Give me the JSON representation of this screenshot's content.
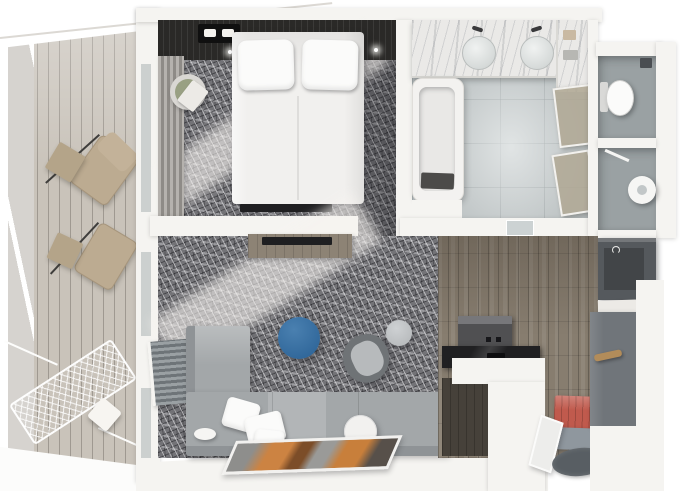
{
  "scene": {
    "kind": "3d-floor-plan-render",
    "view": "top-down cutaway (dollhouse)",
    "unit": "one-bedroom suite with balcony",
    "size": "680x491"
  },
  "palette": {
    "wall": "#f5f4f1",
    "wall-shade": "#e2e0db",
    "deck": "#c9c3ba",
    "railing-glass": "#d6d3cf",
    "carpet": "#737377",
    "bed": "#f1f0ee",
    "pillow": "#fbfbfa",
    "headboard": "#2a2927",
    "wood": "#877d6f",
    "tile": "#b9bfc0",
    "marble": "#eae9e7",
    "wc-floor": "#9aa1a3",
    "sofa": "#a3a7a9",
    "sofa-shade": "#8f9396",
    "ottoman-blue": "#31689b",
    "armchair": "#6f7376",
    "pouf": "#b9bcbe",
    "bench-coral": "#c05a4d",
    "rug-dark": "#585e63",
    "closet": "#55595d",
    "wardrobe": "#70757a",
    "rod-wood": "#b28c5a",
    "curtain-a": "#b5b2ae",
    "curtain-b": "#8e8b87",
    "cushion-beige": "#bcab91",
    "table-beige": "#b4a489",
    "tv-dark": "#1f1f21",
    "counter-dark": "#202022",
    "cabinet-dark": "#46413a",
    "appliance": "#505052",
    "art-orange": "#cc8342",
    "console-wood": "#8d8375"
  },
  "rooms": [
    {
      "id": "balcony",
      "name": "Balcony",
      "floor": "wood slat decking",
      "items": [
        "lounge chair",
        "lounge chair",
        "beige side table",
        "beige side table",
        "rope hammock",
        "white throw pillow",
        "glass railing"
      ]
    },
    {
      "id": "bedroom",
      "name": "Bedroom",
      "floor": "grey patterned carpet",
      "items": [
        "double bed",
        "two pillows",
        "dark headboard wall",
        "ceiling light fixture",
        "round lounge chair",
        "pleated curtains",
        "wall tv"
      ]
    },
    {
      "id": "bathroom",
      "name": "Bathroom",
      "floor": "grey tile",
      "items": [
        "marble double vanity",
        "vessel sink",
        "vessel sink",
        "faucet",
        "faucet",
        "bathtub",
        "bath tray",
        "glass door",
        "glass door",
        "glass interior door"
      ]
    },
    {
      "id": "wc",
      "name": "WC room",
      "floor": "grey tile",
      "items": [
        "toilet"
      ]
    },
    {
      "id": "shower-room",
      "name": "Shower room",
      "floor": "grey tile",
      "items": [
        "round shower tray",
        "squeegee"
      ]
    },
    {
      "id": "living-room",
      "name": "Living room",
      "floor": "grey patterned carpet",
      "items": [
        "corner sofa",
        "white throw pillows",
        "blue round ottoman",
        "swivel armchair",
        "grey pouf",
        "round white side table",
        "floor artwork",
        "slatted radiator bench",
        "tv console",
        "media tv"
      ]
    },
    {
      "id": "kitchen",
      "name": "Kitchenette",
      "floor": "wood plank",
      "items": [
        "appliance unit",
        "dark countertop",
        "white counter block",
        "dark base cabinet"
      ]
    },
    {
      "id": "entry",
      "name": "Entry hall",
      "floor": "wood plank",
      "items": [
        "coral tufted bench",
        "leaning mirror",
        "oval dark rug",
        "grey platform"
      ]
    },
    {
      "id": "wardrobe-hall",
      "name": "Wardrobe hall",
      "floor": "wood plank",
      "items": [
        "dark closet",
        "open shelf",
        "wardrobe panel",
        "wooden hanging rod"
      ]
    }
  ]
}
